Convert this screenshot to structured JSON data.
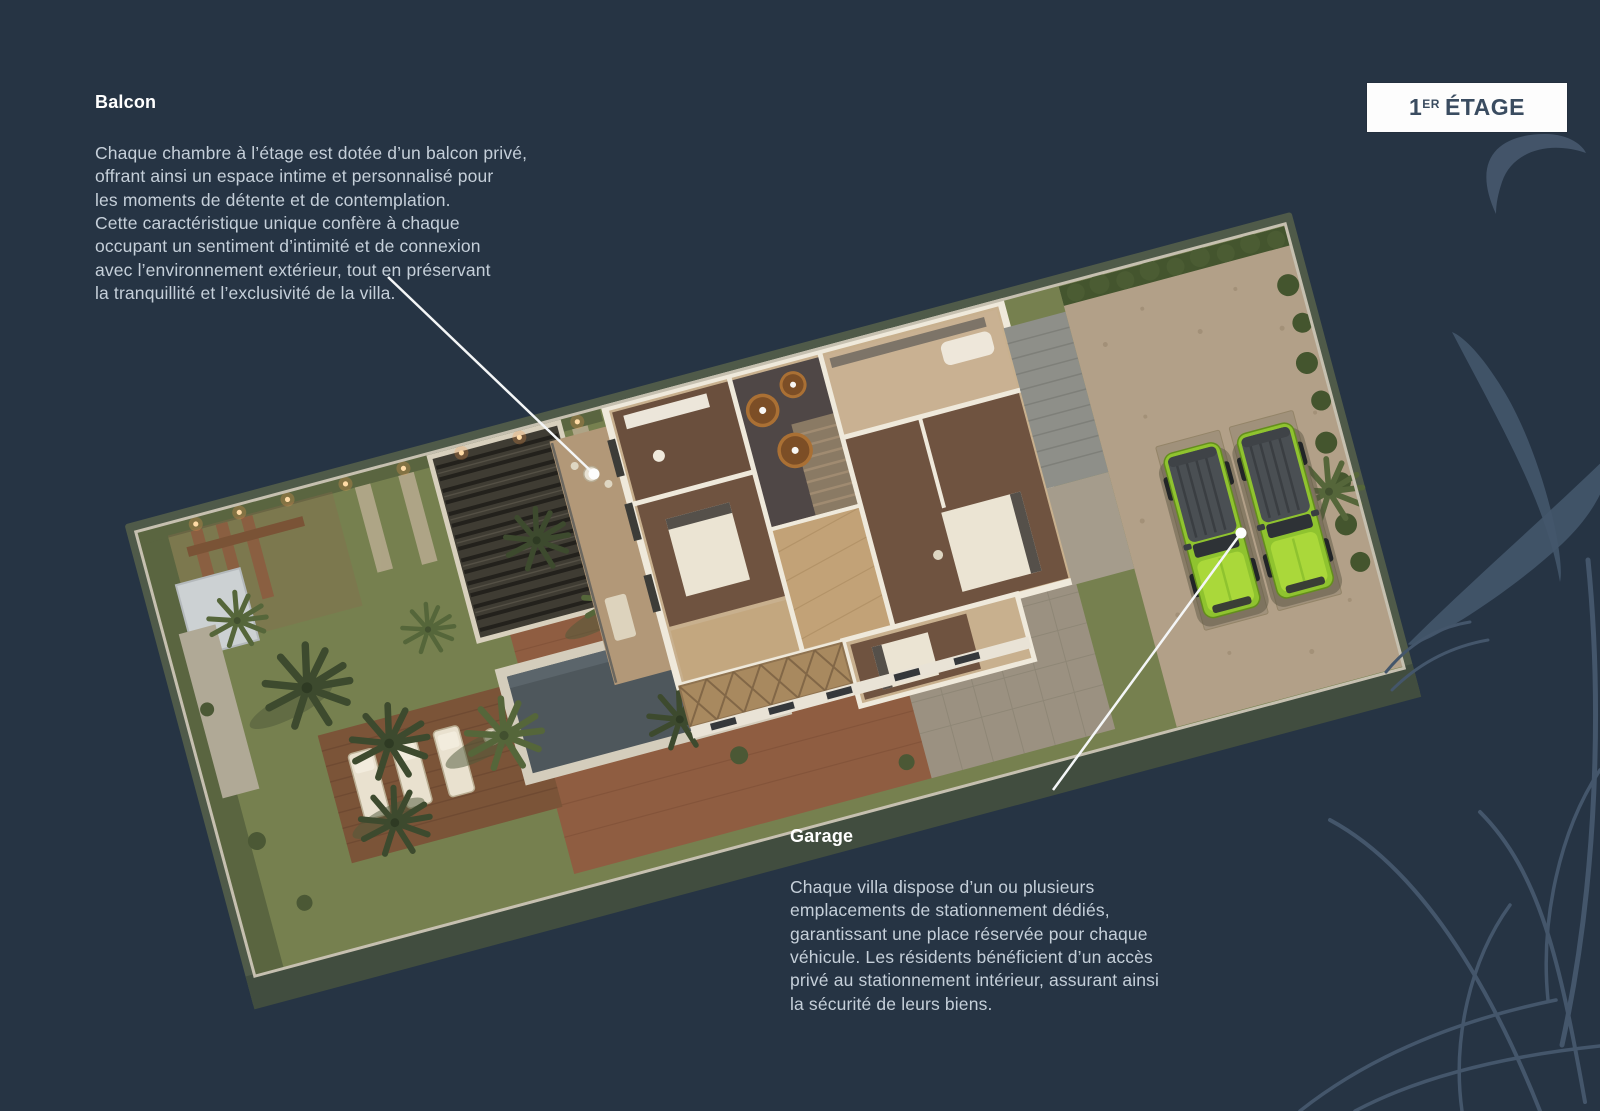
{
  "slide": {
    "background_color": "#263444",
    "callout_color": "#f4f6f7",
    "plant_art_color": "#44566b"
  },
  "floor_badge": {
    "number": "1",
    "ordinal": "ER",
    "label": "ÉTAGE",
    "background": "#fdfdfd",
    "text_color": "#3a4c60"
  },
  "annotations": {
    "balcony": {
      "title": "Balcon",
      "body": "Chaque chambre à l’étage est dotée d’un balcon privé,\noffrant ainsi un espace intime et personnalisé pour\nles moments de détente et de contemplation.\nCette caractéristique unique confère à chaque\noccupant un sentiment d’intimité et de connexion\navec l’environnement extérieur, tout en préservant\nla tranquillité et l’exclusivité de la villa."
    },
    "garage": {
      "title": "Garage",
      "body": "Chaque villa dispose d’un ou plusieurs\nemplacements de stationnement dédiés,\ngarantissant une place réservée pour chaque\nvéhicule. Les résidents bénéficient d’un accès\nprivé au stationnement intérieur, assurant ainsi\nla sécurité de leurs biens."
    }
  }
}
